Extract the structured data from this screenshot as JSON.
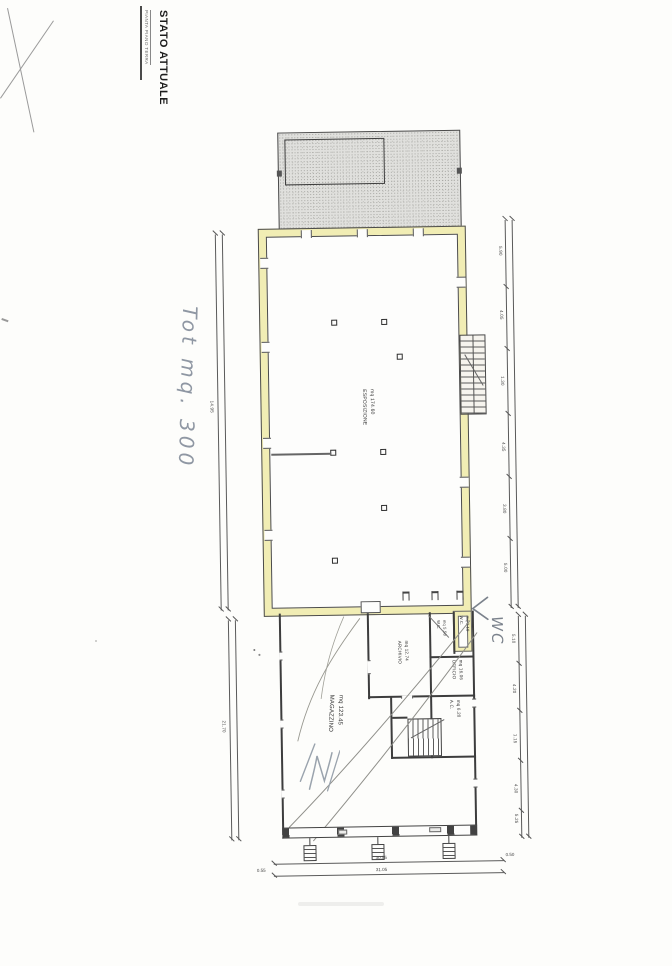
{
  "sheet": {
    "caption": "PIANTA PIANO TERRA",
    "title": "STATO ATTUALE"
  },
  "handwritten": {
    "total_area_note": "Tot mq. 300",
    "wc_note": "WC"
  },
  "rooms": {
    "esposizione": {
      "name": "ESPOSIZIONE",
      "area": "mq 174.60"
    },
    "archivio": {
      "name": "ARCHIVIO",
      "area": "mq 12.74"
    },
    "wc_1": {
      "name": "W.C.",
      "area": "mq 5.58"
    },
    "wc_2": {
      "name": "W.C.",
      "area": "mq 3.18"
    },
    "ufficio": {
      "name": "UFFICIO",
      "area": "mq 16.06"
    },
    "ac": {
      "name": "A.C.",
      "area": "mq 6.20"
    },
    "magazzino": {
      "name": "MAGAZZINO",
      "area": "mq 123.45"
    }
  },
  "dimensions": {
    "left_upper_total": "14.95",
    "left_lower_total": "21.70",
    "right_upper_ticks": [
      "5.90",
      "4.05",
      "1.30",
      "4.35",
      "3.80",
      "5.00"
    ],
    "right_lower_ticks": [
      "5.10",
      "4.20",
      "1.15",
      "4.30",
      "5.25"
    ],
    "bottom_inner_total": "30.55",
    "bottom_outer_total": "31.05",
    "bottom_left_offset": "0.55",
    "bottom_right_offset": "0.50"
  },
  "colors": {
    "wall_highlight": "#f1edb4",
    "handwriting_ink": "#8f97a3",
    "wall_line": "#3d3d3d"
  }
}
